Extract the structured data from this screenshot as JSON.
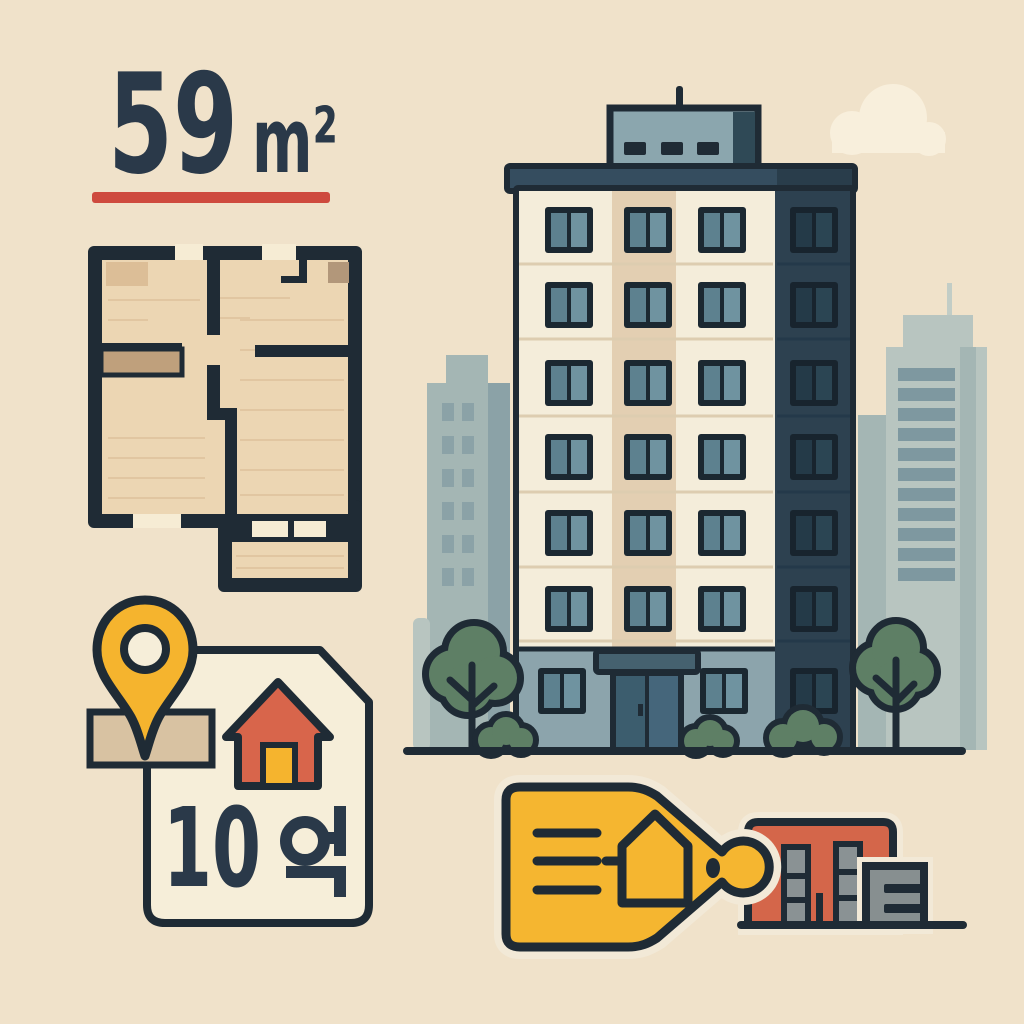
{
  "area_label": {
    "value": "59",
    "unit": "m²",
    "combined": "59m²"
  },
  "price_card": {
    "price": "10억",
    "digits": "10",
    "unit_glyph": "억"
  },
  "icons": [
    "location-pin",
    "house",
    "price-tag",
    "apartment-building",
    "floor-plan",
    "tree",
    "bush",
    "cloud",
    "city-skyline",
    "small-buildings"
  ],
  "palette": {
    "background": "#f0e2ca",
    "ink": "#1f2b35",
    "text-navy": "#2a3949",
    "accent-red": "#ce4a3e",
    "pin-yellow": "#f5b42e",
    "tag-yellow": "#f5b630",
    "house-red": "#d8654b",
    "card-cream": "#f6eed9",
    "gap-cream": "#f6ecd4",
    "room-beige": "#ecd6b3",
    "closet-tan": "#bfa07c",
    "accent-square-tan": "#b2977a",
    "window-beige": "#dcbe97",
    "base-tan": "#d8c2a2",
    "facade-cream": "#f4edda",
    "facade-tan": "#e3cfb2",
    "facade-dark": "#2d4150",
    "seam-light": "#ddcdb0",
    "seam-dark": "#24394a",
    "frame-dark": "#1b2831",
    "pane-light-a": "#5d818f",
    "pane-light-b": "#6f93a0",
    "pane-dark-a": "#243a48",
    "pane-dark-b": "#2b4553",
    "ground-floor": "#8ca4ac",
    "roof-slab": "#354d5f",
    "roof-slab-dark": "#293d4b",
    "penthouse": "#8ba6ae",
    "penthouse-dark": "#2f4956",
    "door-a": "#3c5d6e",
    "door-b": "#45667b",
    "canopy": "#45616f",
    "skyline-light": "#b8c5c0",
    "skyline-mid": "#a4b6b4",
    "skyline-dark": "#8ba2a7",
    "stripe": "#7e98a0",
    "antenna-gray": "#c2cdc6",
    "tree-green": "#5e7f65",
    "cloud": "#f8efdc",
    "halo": "#f2e9d7",
    "small-red": "#d4664a",
    "small-gray": "#878f90",
    "win-gray": "#8a9294",
    "grain": "#d8ba92"
  }
}
